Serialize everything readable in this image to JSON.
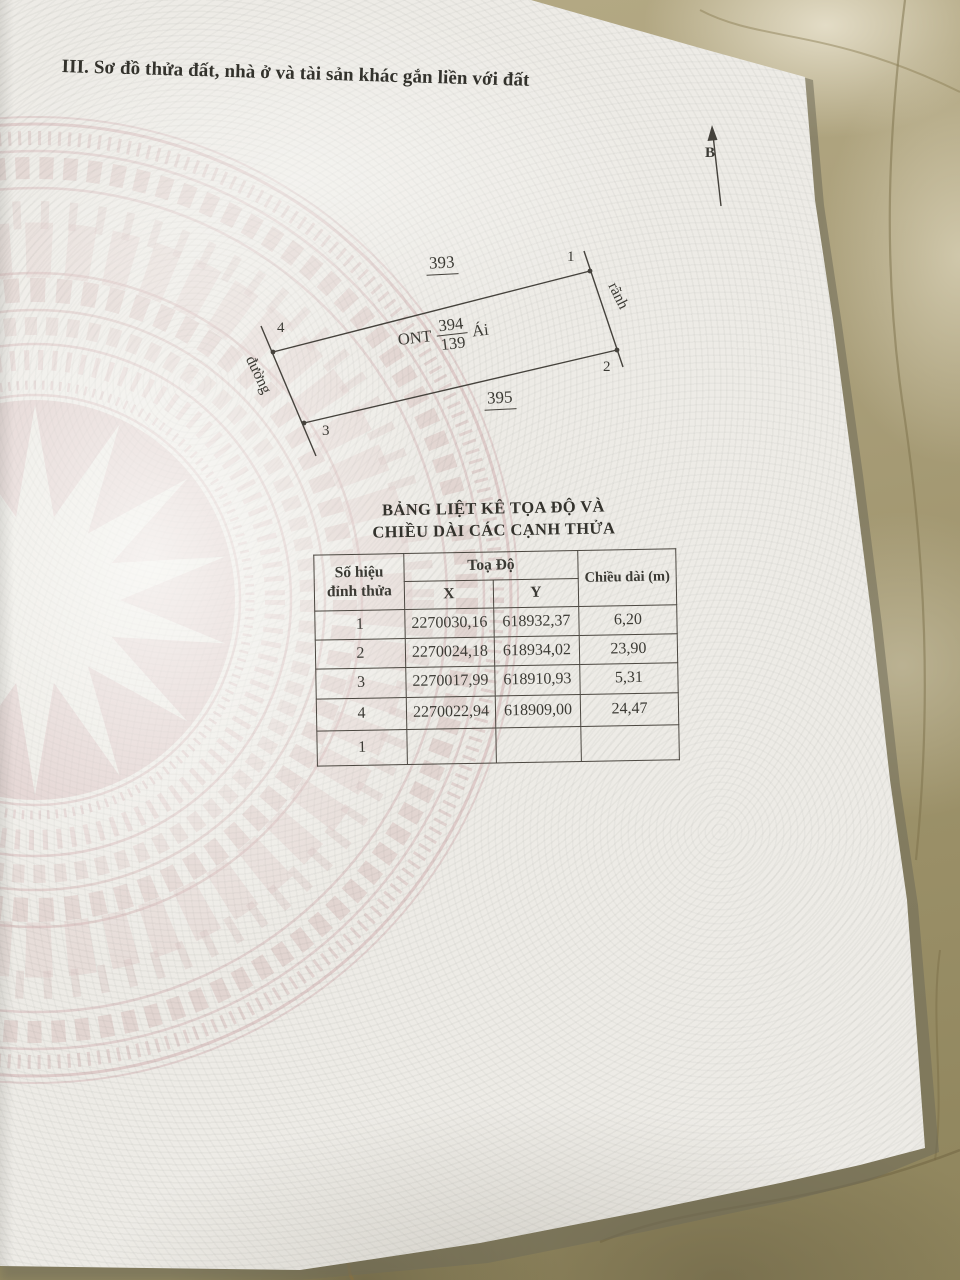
{
  "document": {
    "section_title": "III. Sơ đồ thửa đất, nhà ở và tài sản khác gắn liền với đất",
    "north_label": "B"
  },
  "diagram": {
    "corner_labels": [
      "1",
      "2",
      "3",
      "4"
    ],
    "adjacent_parcel_top": "393",
    "adjacent_parcel_bottom": "395",
    "left_feature": "đường",
    "right_feature": "rãnh",
    "land_use_code": "ONT",
    "parcel_number": "394",
    "parcel_area": "139",
    "name_suffix": "Ái"
  },
  "coordinate_table": {
    "title_line1": "BẢNG LIỆT KÊ TỌA ĐỘ VÀ",
    "title_line2": "CHIỀU DÀI CÁC CẠNH THỬA",
    "header": {
      "vertex_line1": "Số hiệu",
      "vertex_line2": "đỉnh thửa",
      "coords": "Toạ Độ",
      "x": "X",
      "y": "Y",
      "length": "Chiều dài (m)"
    },
    "rows": [
      {
        "id": "1",
        "x": "2270030,16",
        "y": "618932,37",
        "length": "6,20"
      },
      {
        "id": "2",
        "x": "2270024,18",
        "y": "618934,02",
        "length": "23,90"
      },
      {
        "id": "3",
        "x": "2270017,99",
        "y": "618910,93",
        "length": "5,31"
      },
      {
        "id": "4",
        "x": "2270022,94",
        "y": "618909,00",
        "length": "24,47"
      },
      {
        "id": "1",
        "x": "",
        "y": "",
        "length": ""
      }
    ]
  },
  "colors": {
    "paper": "#edebe6",
    "ink": "#3b3a34",
    "line": "#4b4740",
    "watermark_pink": "#d6bbba",
    "marble_tan": "#a39871"
  }
}
